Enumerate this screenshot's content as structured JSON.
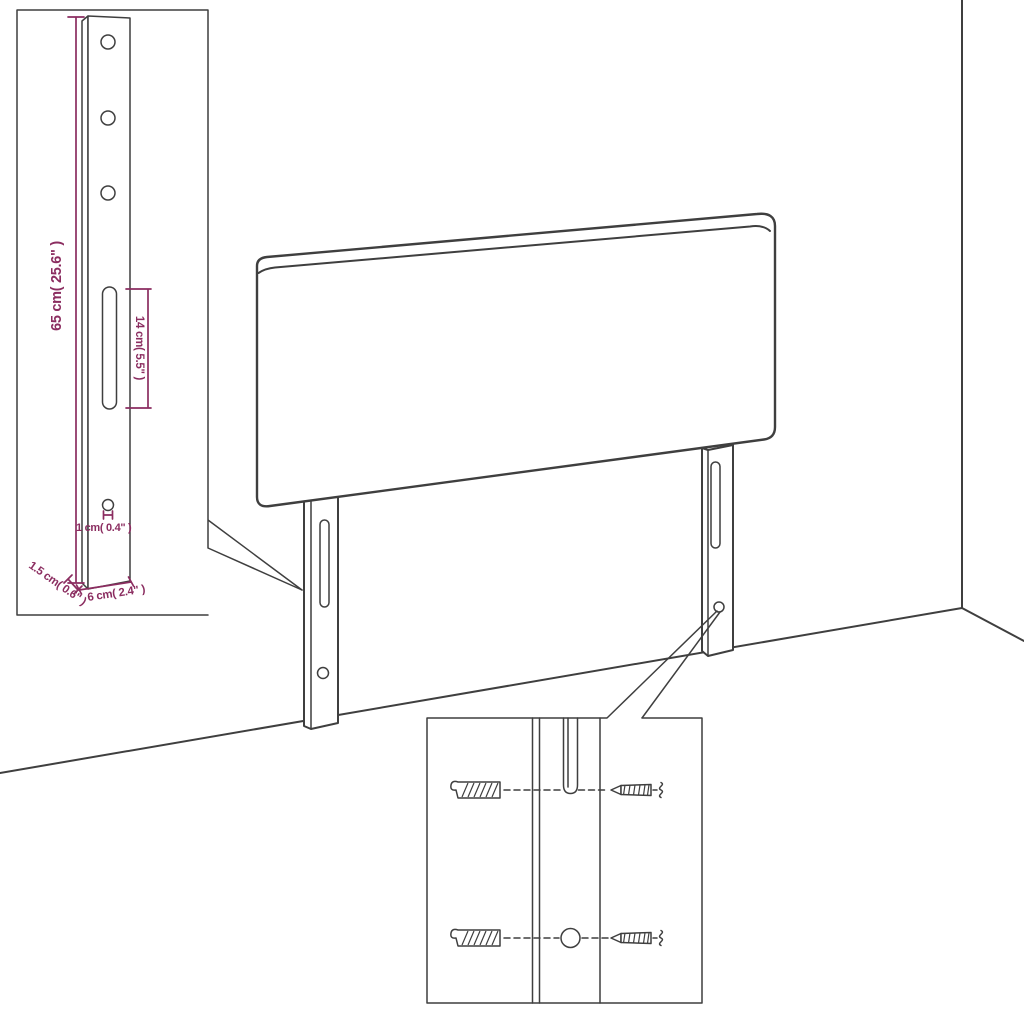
{
  "colors": {
    "line": "#3f3f3f",
    "dimension": "#8b2d60",
    "background": "#ffffff"
  },
  "inset_bracket_detail": {
    "dimensions": {
      "height": "65 cm( 25.6\" )",
      "slot_length": "14 cm( 5.5\" )",
      "hole_diameter": "1 cm( 0.4\" )",
      "thickness": "1.5 cm( 0.6\" )",
      "width": "6 cm( 2.4\" )"
    }
  },
  "inset_mounting_detail": {
    "icons": [
      "wall-plug-icon",
      "screw-icon",
      "wall-plug-icon",
      "screw-icon"
    ]
  }
}
